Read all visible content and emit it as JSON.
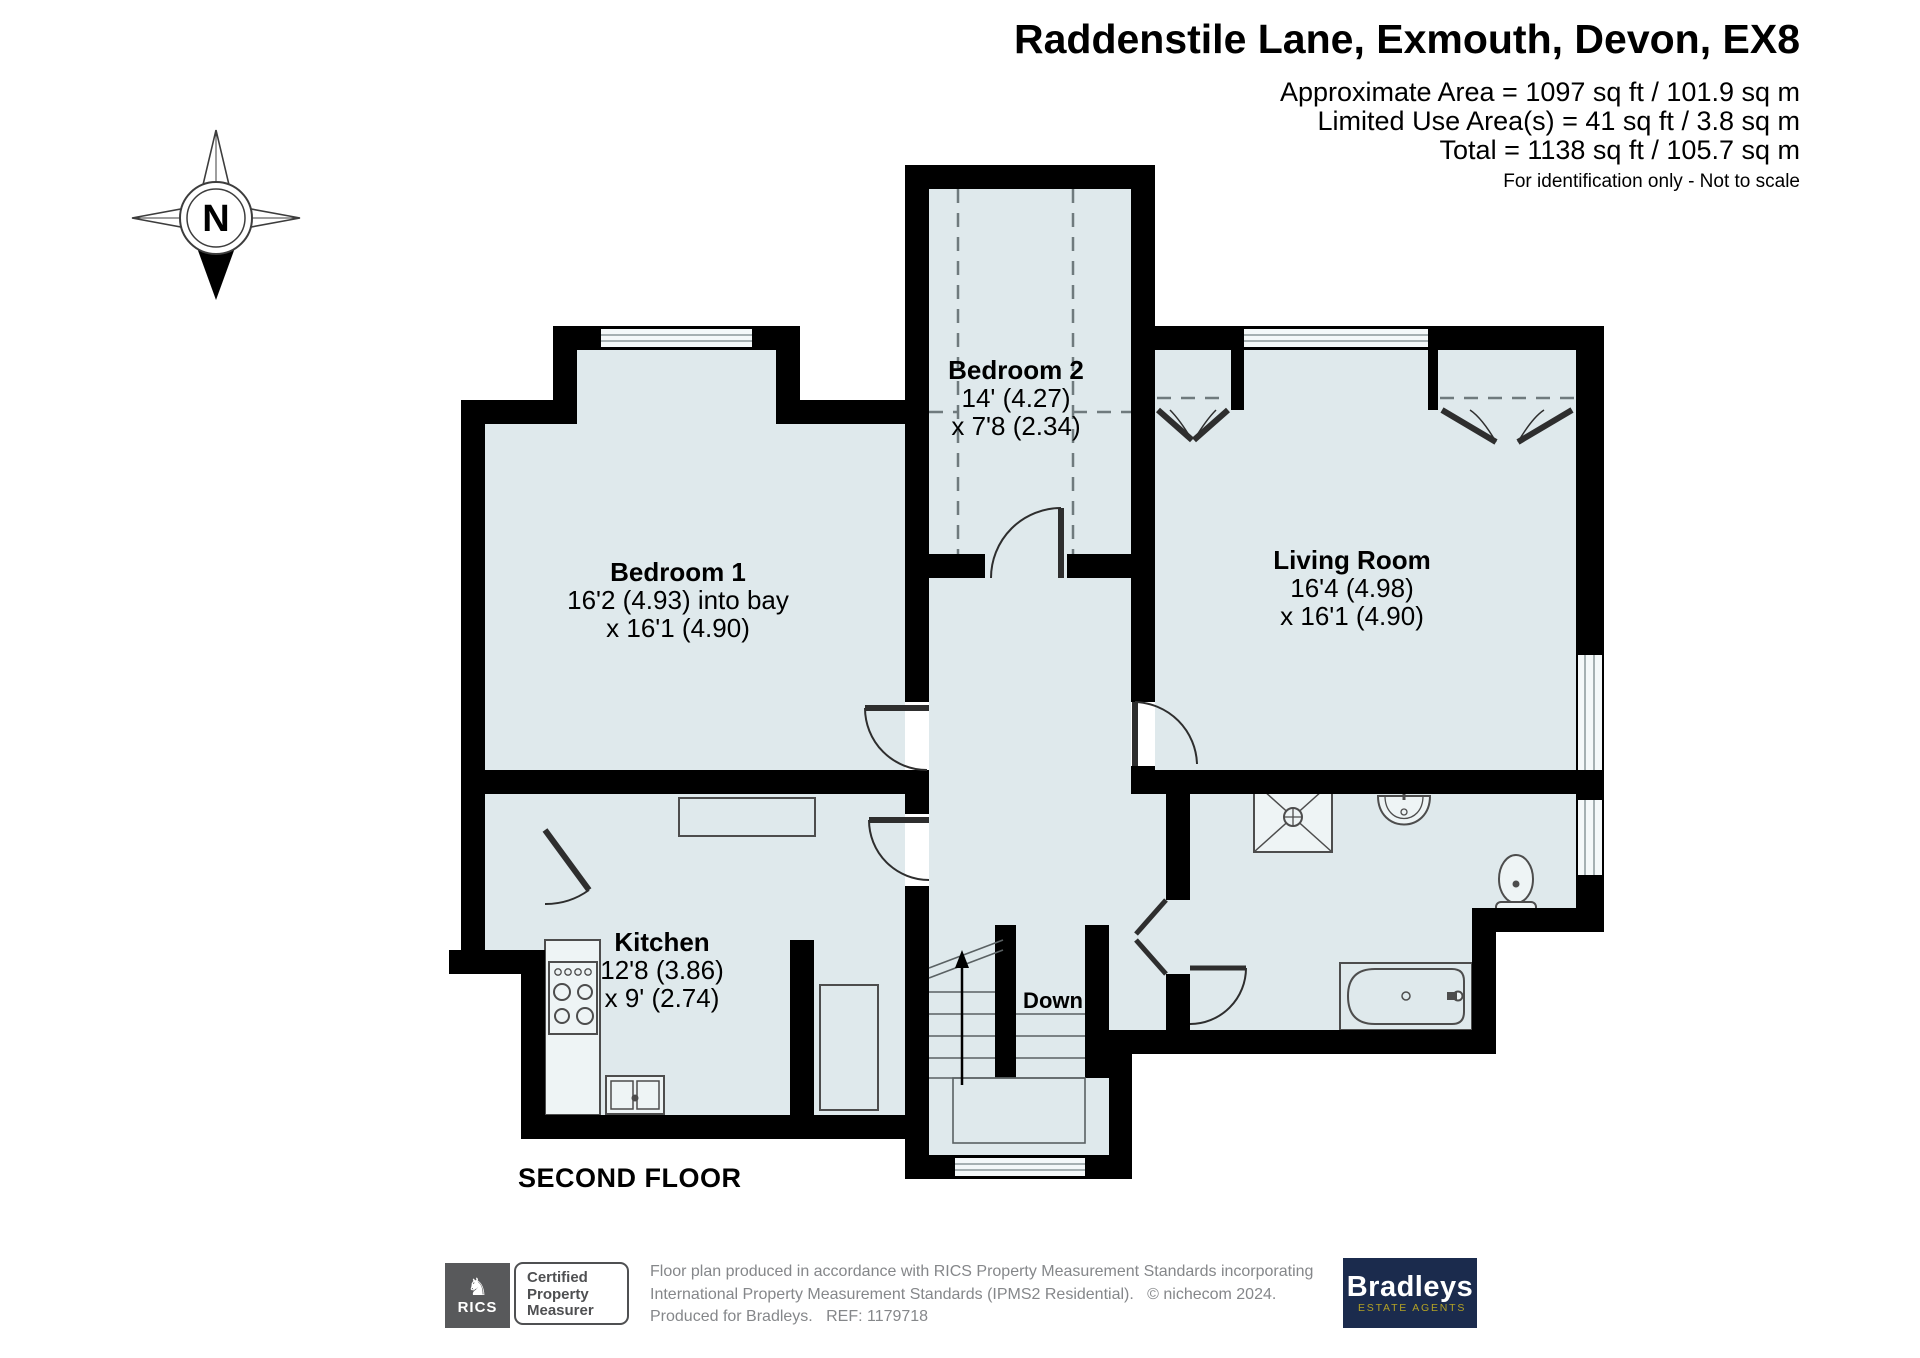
{
  "header": {
    "title": "Raddenstile Lane, Exmouth, Devon, EX8",
    "area_lines": [
      "Approximate Area = 1097 sq ft / 101.9 sq m",
      "Limited Use Area(s) = 41 sq ft / 3.8 sq m",
      "Total = 1138 sq ft / 105.7 sq m"
    ],
    "note": "For identification only - Not to scale"
  },
  "compass": {
    "north_label": "N"
  },
  "rooms": {
    "bedroom2": {
      "name": "Bedroom 2",
      "dims": [
        "14' (4.27)",
        "x 7'8 (2.34)"
      ]
    },
    "bedroom1": {
      "name": "Bedroom 1",
      "dims": [
        "16'2 (4.93) into bay",
        "x 16'1 (4.90)"
      ]
    },
    "living": {
      "name": "Living Room",
      "dims": [
        "16'4 (4.98)",
        "x 16'1 (4.90)"
      ]
    },
    "kitchen": {
      "name": "Kitchen",
      "dims": [
        "12'8 (3.86)",
        "x 9' (2.74)"
      ]
    }
  },
  "stairs": {
    "label": "Down"
  },
  "floor_label": "SECOND FLOOR",
  "footer": {
    "rics": {
      "brand": "RICS",
      "certification": [
        "Certified",
        "Property",
        "Measurer"
      ]
    },
    "disclaimer": [
      "Floor plan produced in accordance with RICS Property Measurement Standards incorporating",
      "International Property Measurement Standards (IPMS2 Residential).   © nichecom 2024.",
      "Produced for Bradleys.   REF: 1179718"
    ],
    "agent": {
      "name": "Bradleys",
      "tagline": "ESTATE AGENTS"
    }
  },
  "colors": {
    "room_fill": "#dfe9ec",
    "wall": "#000000",
    "agent_navy": "#1b2b4d",
    "agent_gold": "#b3a125",
    "muted_text": "#85878a",
    "rics_gray": "#58595b"
  }
}
